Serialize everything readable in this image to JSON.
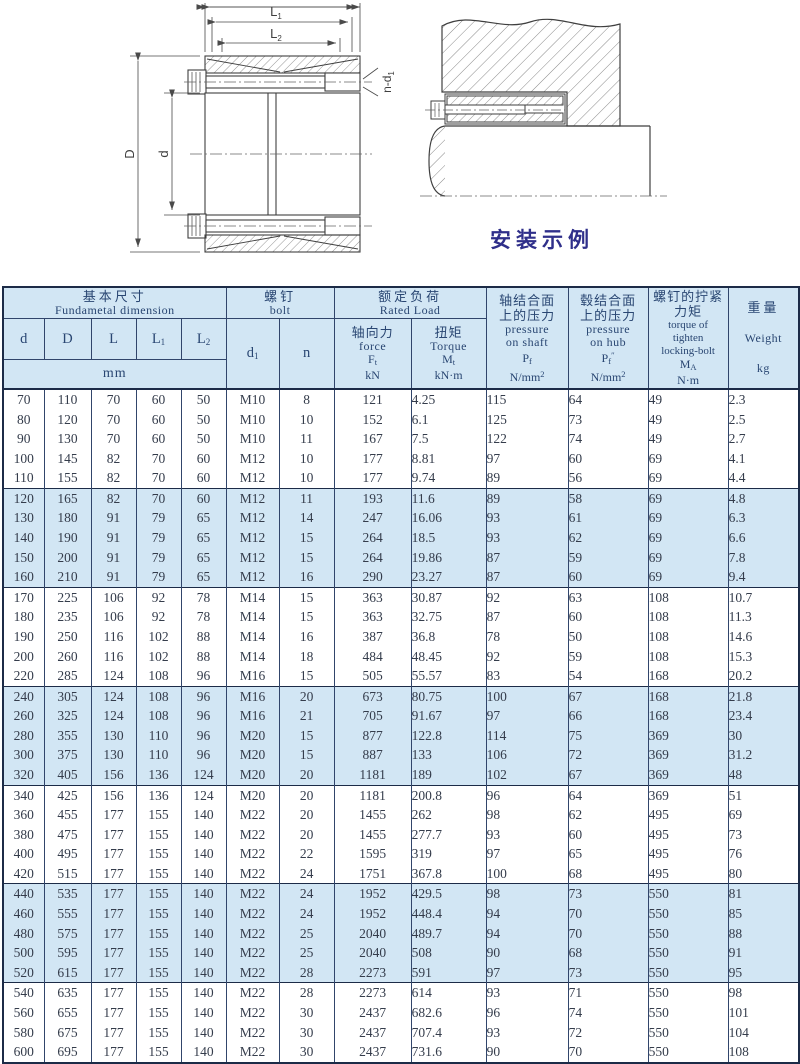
{
  "colors": {
    "band_blue": "#d2e6f4",
    "border_navy": "#1c2b47",
    "caption_navy": "#2f2f8a"
  },
  "figure_left": {
    "dim_l1": {
      "base": "L",
      "sub": "1"
    },
    "dim_l2": {
      "base": "L",
      "sub": "2"
    },
    "dim_outer": "D",
    "dim_bore": "d",
    "bolt_note": {
      "base": "n-d",
      "sub": "1"
    }
  },
  "figure_right": {
    "caption": "安装示例"
  },
  "table": {
    "header": {
      "basic": {
        "zh": "基本尺寸",
        "en": "Fundametal  dimension",
        "unit": "mm",
        "cols": [
          {
            "base": "d",
            "sub": ""
          },
          {
            "base": "D",
            "sub": ""
          },
          {
            "base": "L",
            "sub": ""
          },
          {
            "base": "L",
            "sub": "1"
          },
          {
            "base": "L",
            "sub": "2"
          }
        ]
      },
      "bolt": {
        "zh": "螺钉",
        "en": "bolt",
        "d1": {
          "base": "d",
          "sub": "1"
        },
        "n": "n"
      },
      "rated": {
        "zh": "额定负荷",
        "en": "Rated  Load",
        "force": {
          "zh": "轴向力",
          "en": "force",
          "sym": {
            "base": "F",
            "sub": "t"
          },
          "unit": "kN"
        },
        "torque": {
          "zh": "扭矩",
          "en": "Torque",
          "sym": {
            "base": "M",
            "sub": "t"
          },
          "unit": "kN·m"
        }
      },
      "pressure_shaft": {
        "zh1": "轴结合面",
        "zh2": "上的压力",
        "en1": "pressure",
        "en2": "on shaft",
        "sym": {
          "base": "P",
          "sub": "f",
          "sup": ""
        },
        "unit": {
          "base": "N/mm",
          "sup": "2"
        }
      },
      "pressure_hub": {
        "zh1": "毂结合面",
        "zh2": "上的压力",
        "en1": "pressure",
        "en2": "on hub",
        "sym": {
          "base": "P",
          "sub": "f",
          "sup": "″"
        },
        "unit": {
          "base": "N/mm",
          "sup": "2"
        }
      },
      "bolt_torque": {
        "zh1": "螺钉的拧紧",
        "zh2": "力矩",
        "en1": "torque of",
        "en2": "tighten",
        "en3": "locking-bolt",
        "sym": {
          "base": "M",
          "sub": "A"
        },
        "unit": "N·m"
      },
      "weight": {
        "zh": "重量",
        "en": "Weight",
        "unit": "kg"
      }
    },
    "rows": [
      [
        "70",
        "110",
        "70",
        "60",
        "50",
        "M10",
        "8",
        "121",
        "4.25",
        "115",
        "64",
        "49",
        "2.3"
      ],
      [
        "80",
        "120",
        "70",
        "60",
        "50",
        "M10",
        "10",
        "152",
        "6.1",
        "125",
        "73",
        "49",
        "2.5"
      ],
      [
        "90",
        "130",
        "70",
        "60",
        "50",
        "M10",
        "11",
        "167",
        "7.5",
        "122",
        "74",
        "49",
        "2.7"
      ],
      [
        "100",
        "145",
        "82",
        "70",
        "60",
        "M12",
        "10",
        "177",
        "8.81",
        "97",
        "60",
        "69",
        "4.1"
      ],
      [
        "110",
        "155",
        "82",
        "70",
        "60",
        "M12",
        "10",
        "177",
        "9.74",
        "89",
        "56",
        "69",
        "4.4"
      ],
      [
        "120",
        "165",
        "82",
        "70",
        "60",
        "M12",
        "11",
        "193",
        "11.6",
        "89",
        "58",
        "69",
        "4.8"
      ],
      [
        "130",
        "180",
        "91",
        "79",
        "65",
        "M12",
        "14",
        "247",
        "16.06",
        "93",
        "61",
        "69",
        "6.3"
      ],
      [
        "140",
        "190",
        "91",
        "79",
        "65",
        "M12",
        "15",
        "264",
        "18.5",
        "93",
        "62",
        "69",
        "6.6"
      ],
      [
        "150",
        "200",
        "91",
        "79",
        "65",
        "M12",
        "15",
        "264",
        "19.86",
        "87",
        "59",
        "69",
        "7.8"
      ],
      [
        "160",
        "210",
        "91",
        "79",
        "65",
        "M12",
        "16",
        "290",
        "23.27",
        "87",
        "60",
        "69",
        "9.4"
      ],
      [
        "170",
        "225",
        "106",
        "92",
        "78",
        "M14",
        "15",
        "363",
        "30.87",
        "92",
        "63",
        "108",
        "10.7"
      ],
      [
        "180",
        "235",
        "106",
        "92",
        "78",
        "M14",
        "15",
        "363",
        "32.75",
        "87",
        "60",
        "108",
        "11.3"
      ],
      [
        "190",
        "250",
        "116",
        "102",
        "88",
        "M14",
        "16",
        "387",
        "36.8",
        "78",
        "50",
        "108",
        "14.6"
      ],
      [
        "200",
        "260",
        "116",
        "102",
        "88",
        "M14",
        "18",
        "484",
        "48.45",
        "92",
        "59",
        "108",
        "15.3"
      ],
      [
        "220",
        "285",
        "124",
        "108",
        "96",
        "M16",
        "15",
        "505",
        "55.57",
        "83",
        "54",
        "168",
        "20.2"
      ],
      [
        "240",
        "305",
        "124",
        "108",
        "96",
        "M16",
        "20",
        "673",
        "80.75",
        "100",
        "67",
        "168",
        "21.8"
      ],
      [
        "260",
        "325",
        "124",
        "108",
        "96",
        "M16",
        "21",
        "705",
        "91.67",
        "97",
        "66",
        "168",
        "23.4"
      ],
      [
        "280",
        "355",
        "130",
        "110",
        "96",
        "M20",
        "15",
        "877",
        "122.8",
        "114",
        "75",
        "369",
        "30"
      ],
      [
        "300",
        "375",
        "130",
        "110",
        "96",
        "M20",
        "15",
        "887",
        "133",
        "106",
        "72",
        "369",
        "31.2"
      ],
      [
        "320",
        "405",
        "156",
        "136",
        "124",
        "M20",
        "20",
        "1181",
        "189",
        "102",
        "67",
        "369",
        "48"
      ],
      [
        "340",
        "425",
        "156",
        "136",
        "124",
        "M20",
        "20",
        "1181",
        "200.8",
        "96",
        "64",
        "369",
        "51"
      ],
      [
        "360",
        "455",
        "177",
        "155",
        "140",
        "M22",
        "20",
        "1455",
        "262",
        "98",
        "62",
        "495",
        "69"
      ],
      [
        "380",
        "475",
        "177",
        "155",
        "140",
        "M22",
        "20",
        "1455",
        "277.7",
        "93",
        "60",
        "495",
        "73"
      ],
      [
        "400",
        "495",
        "177",
        "155",
        "140",
        "M22",
        "22",
        "1595",
        "319",
        "97",
        "65",
        "495",
        "76"
      ],
      [
        "420",
        "515",
        "177",
        "155",
        "140",
        "M22",
        "24",
        "1751",
        "367.8",
        "100",
        "68",
        "495",
        "80"
      ],
      [
        "440",
        "535",
        "177",
        "155",
        "140",
        "M22",
        "24",
        "1952",
        "429.5",
        "98",
        "73",
        "550",
        "81"
      ],
      [
        "460",
        "555",
        "177",
        "155",
        "140",
        "M22",
        "24",
        "1952",
        "448.4",
        "94",
        "70",
        "550",
        "85"
      ],
      [
        "480",
        "575",
        "177",
        "155",
        "140",
        "M22",
        "25",
        "2040",
        "489.7",
        "94",
        "70",
        "550",
        "88"
      ],
      [
        "500",
        "595",
        "177",
        "155",
        "140",
        "M22",
        "25",
        "2040",
        "508",
        "90",
        "68",
        "550",
        "91"
      ],
      [
        "520",
        "615",
        "177",
        "155",
        "140",
        "M22",
        "28",
        "2273",
        "591",
        "97",
        "73",
        "550",
        "95"
      ],
      [
        "540",
        "635",
        "177",
        "155",
        "140",
        "M22",
        "28",
        "2273",
        "614",
        "93",
        "71",
        "550",
        "98"
      ],
      [
        "560",
        "655",
        "177",
        "155",
        "140",
        "M22",
        "30",
        "2437",
        "682.6",
        "96",
        "74",
        "550",
        "101"
      ],
      [
        "580",
        "675",
        "177",
        "155",
        "140",
        "M22",
        "30",
        "2437",
        "707.4",
        "93",
        "72",
        "550",
        "104"
      ],
      [
        "600",
        "695",
        "177",
        "155",
        "140",
        "M22",
        "30",
        "2437",
        "731.6",
        "90",
        "70",
        "550",
        "108"
      ]
    ]
  }
}
